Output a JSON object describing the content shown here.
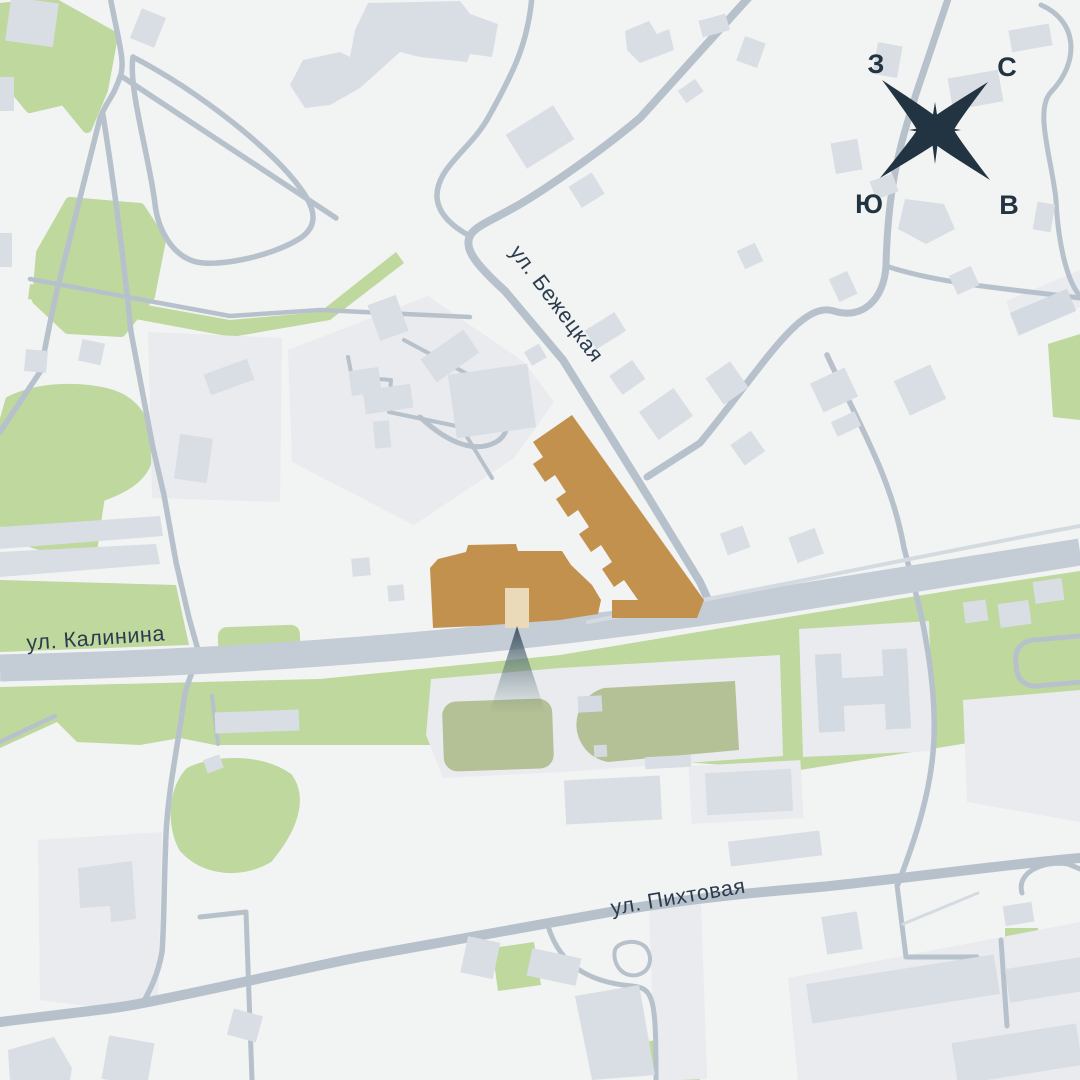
{
  "map": {
    "street_labels": {
      "bezhetskaya": "ул. Бежецкая",
      "kalinina": "ул. Калинина",
      "pikhtovaya": "ул. Пихтовая"
    },
    "compass": {
      "west": "З",
      "north": "С",
      "south": "Ю",
      "east": "В"
    },
    "colors": {
      "bg": "#f2f3f3",
      "road": "#b7c1cb",
      "road-major": "#c4ccd5",
      "road-light": "#d4dbe0",
      "greenery": "#bed89e",
      "field": "#b4c095",
      "pad": "#e9ebee",
      "building": "#d9dee4",
      "building-dark": "#d3dae1",
      "featured": "#c2914e",
      "entrance": "#ebdaba",
      "beacon": "#3e505f",
      "label": "#2b3c4e",
      "compass": "#223442"
    }
  }
}
